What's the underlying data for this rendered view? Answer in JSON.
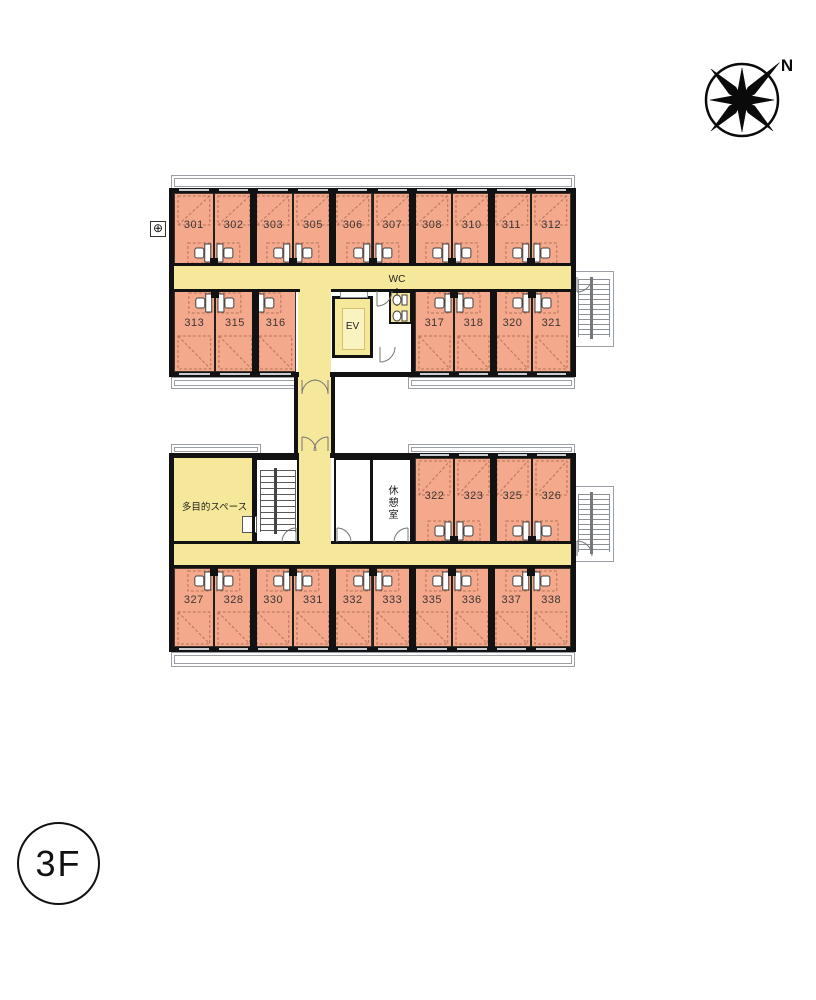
{
  "floor_badge": {
    "label": "3F"
  },
  "compass": {
    "label": "N"
  },
  "areas": {
    "elevator": {
      "label": "EV"
    },
    "toilet": {
      "label": "WC"
    },
    "multipurpose": {
      "label": "多目的スペース"
    },
    "rest_room": {
      "label": "休憩室"
    }
  },
  "rooms": {
    "north_wing_upper": [
      "301",
      "302",
      "303",
      "305",
      "306",
      "307",
      "308",
      "310",
      "311",
      "312"
    ],
    "north_wing_lower_left": [
      "313",
      "315",
      "316"
    ],
    "north_wing_lower_right": [
      "317",
      "318",
      "320",
      "321"
    ],
    "south_wing_upper": [
      "322",
      "323",
      "325",
      "326"
    ],
    "south_wing_lower": [
      "327",
      "328",
      "330",
      "331",
      "332",
      "333",
      "335",
      "336",
      "337",
      "338"
    ]
  },
  "icons": {
    "benchmark": "⊕"
  },
  "colors": {
    "room_fill": "#f4a88c",
    "corridor_fill": "#f6e89a",
    "elevator_inner_fill": "#faf3c0",
    "wall": "#121212",
    "balcony_line": "#9aa0a6"
  }
}
